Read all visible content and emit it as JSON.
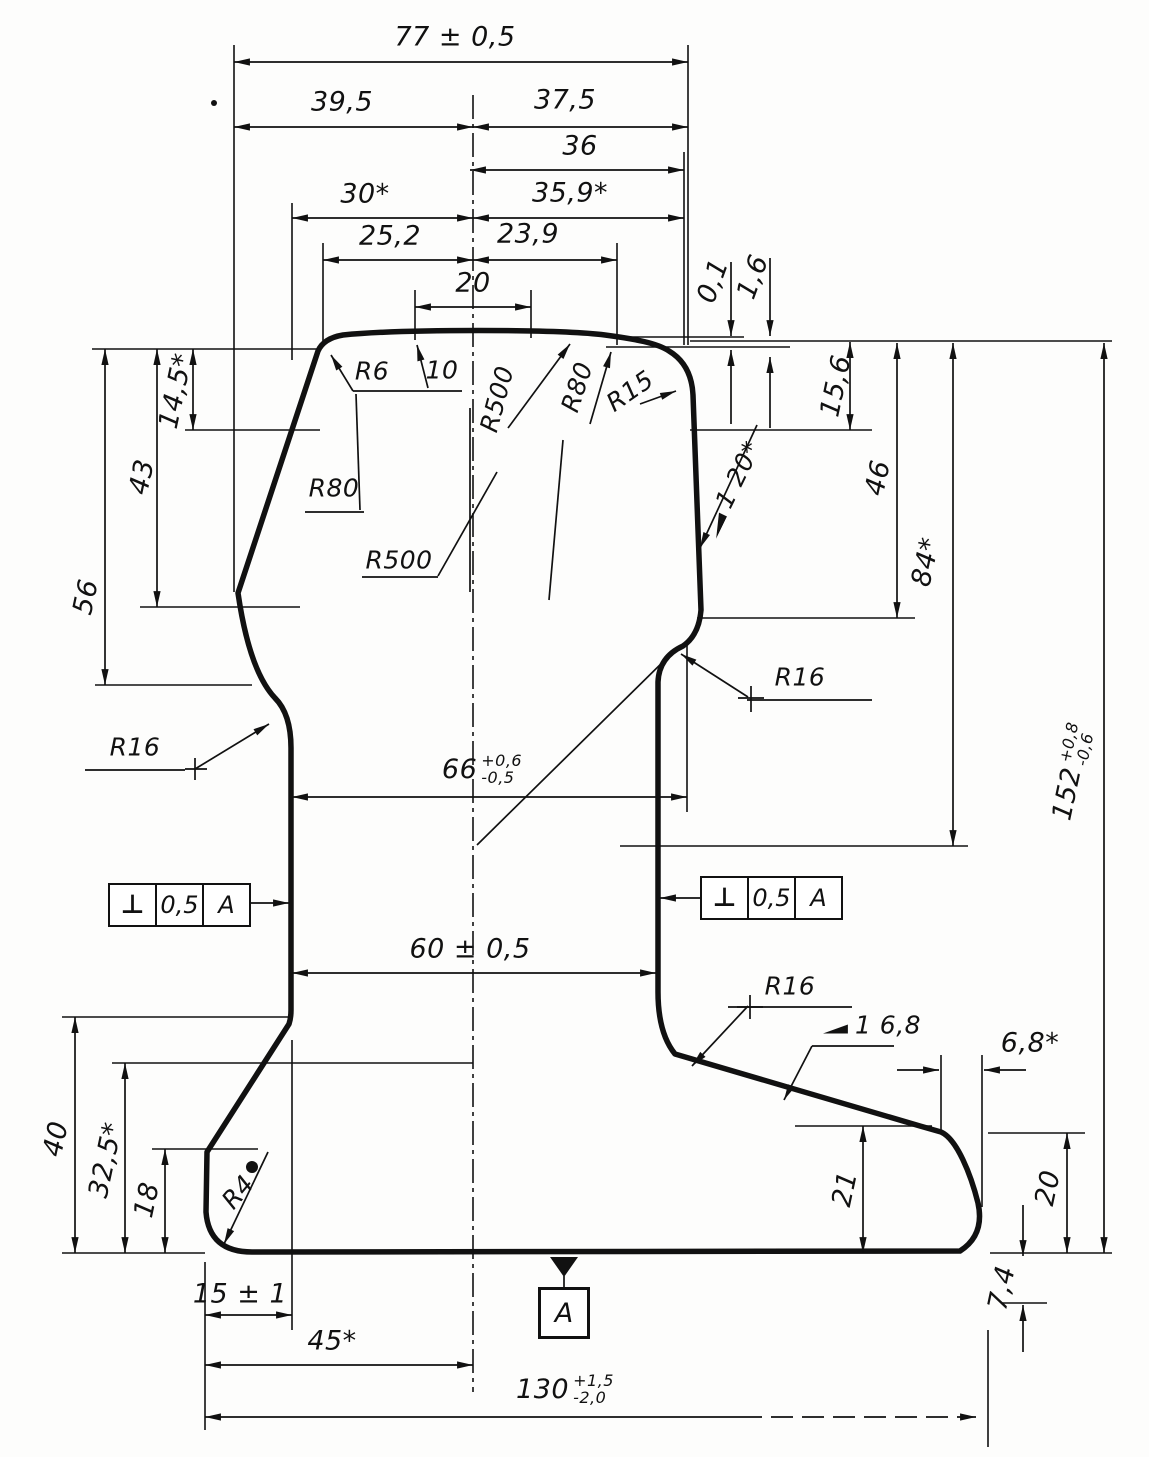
{
  "dims": {
    "d77": "77 ± 0,5",
    "d39_5": "39,5",
    "d37_5": "37,5",
    "d36": "36",
    "d30": "30*",
    "d35_9": "35,9*",
    "d25_2": "25,2",
    "d23_9": "23,9",
    "d20_head": "20",
    "d0_1": "0,1",
    "d1_6": "1,6",
    "d15_6": "15,6",
    "d14_5": "14,5*",
    "d43": "43",
    "d56": "56",
    "d46": "46",
    "d84": "84*",
    "d152": {
      "base": "152",
      "plus": "+0,8",
      "minus": "-0,6"
    },
    "d66": {
      "base": "66",
      "plus": "+0,6",
      "minus": "-0,5"
    },
    "d60": "60 ± 0,5",
    "d40": "40",
    "d32_5": "32,5*",
    "d18": "18",
    "d15": "15 ± 1",
    "d45": "45*",
    "d130": {
      "base": "130",
      "plus": "+1,5",
      "minus": "-2,0"
    },
    "d21": "21",
    "d20_foot": "20",
    "d7_4": "7,4",
    "d6_8": "6,8*"
  },
  "radii": {
    "r6": "R6",
    "n10": "10",
    "r500_crown": "R500",
    "r80_crown": "R80",
    "r15": "R15",
    "r80_left": "R80",
    "r500_left": "R500",
    "r16_web_left": "R16",
    "r16_web_right": "R16",
    "r16_foot_right": "R16",
    "r4": "R4"
  },
  "slopes": {
    "head_side": "1 20*",
    "foot_top": "1 6,8"
  },
  "gdt": {
    "fcf_left": {
      "symbol": "⊥",
      "tol": "0,5",
      "datum": "A"
    },
    "fcf_right": {
      "symbol": "⊥",
      "tol": "0,5",
      "datum": "A"
    },
    "datum_flag": "A"
  },
  "ink": {
    "color": "#111111"
  }
}
